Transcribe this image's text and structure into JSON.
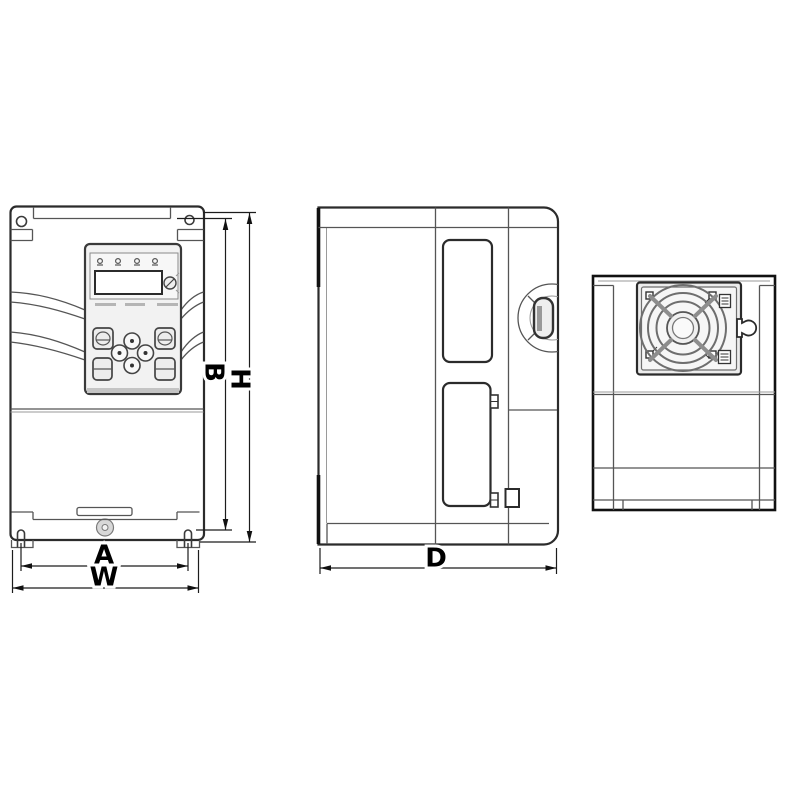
{
  "page": {
    "background": "#ffffff"
  },
  "drawing": {
    "kind": "inverter-dimension-drawing",
    "line_color": "#2b2b2b",
    "mid_line_color": "#555555",
    "light_fill": "#efefef",
    "views": {
      "front": {
        "dim_width_mounting": "A",
        "dim_width_overall": "W",
        "dim_height_mounting": "B",
        "dim_height_overall": "H"
      },
      "side": {
        "dim_depth": "D"
      },
      "top": {}
    }
  }
}
